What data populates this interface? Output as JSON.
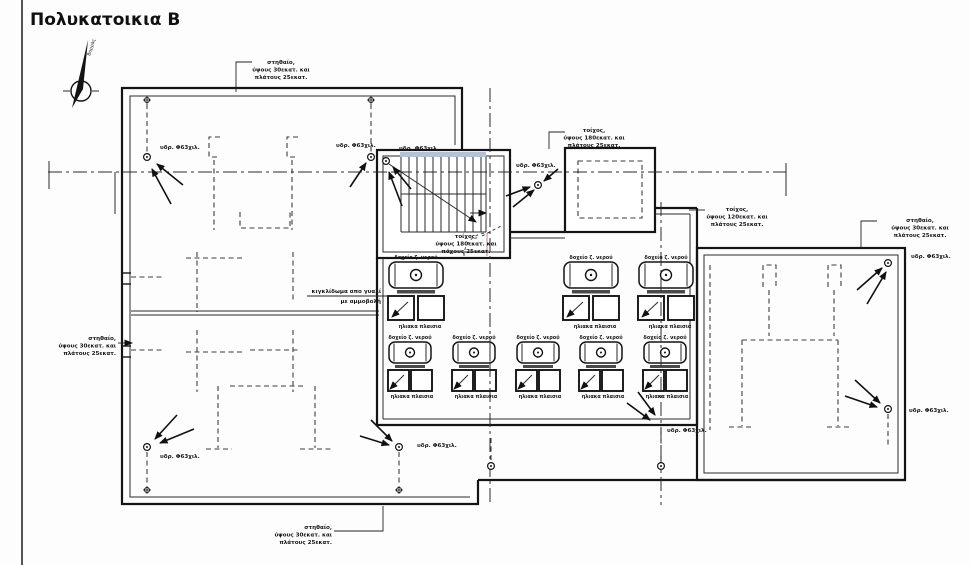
{
  "title": "Πολυκατοικια Β",
  "compass": {
    "north_label": "Βορράς"
  },
  "annotations": {
    "parapet": {
      "l1": "στηθαίο,",
      "l2": "ύψους 30εκατ. και",
      "l3": "πλάτους 25εκατ."
    },
    "wall_180": {
      "l1": "τοίχος,",
      "l2": "ύψους 180εκατ. και",
      "l3": "πλάτους 25εκατ."
    },
    "wall_120": {
      "l1": "τοίχος,",
      "l2": "ύψους 120εκατ. και",
      "l3": "πλάτους 25εκατ."
    },
    "wall_180_thickness": {
      "l1": "τοίχος,",
      "l2": "ύψους 180εκατ. και",
      "l3": "πάχους 25εκατ."
    },
    "glass_railing": {
      "l1": "κιγκλίδωμα απο γυαλί",
      "l2": "με αμμοβολή"
    },
    "drain": "υδρ. Φ63χιλ.",
    "solar_boiler": "δοχείο ζ. νερού",
    "solar_panels": "ηλιακα πλαισια"
  },
  "colors": {
    "line": "#141414",
    "stair_accent": "#b3c2d4",
    "door_leaf": "#cc9999"
  }
}
